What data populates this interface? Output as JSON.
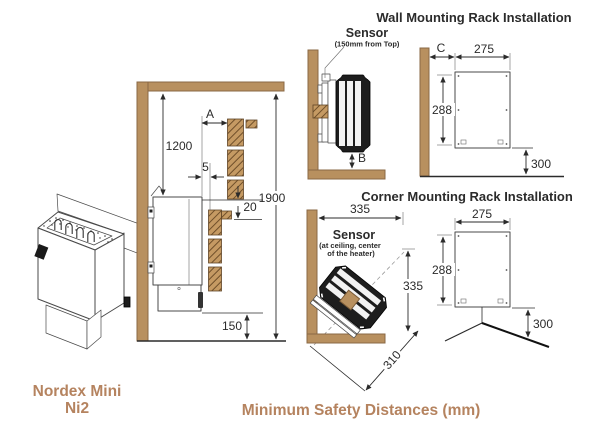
{
  "titles": {
    "wall": "Wall Mounting Rack Installation",
    "corner": "Corner Mounting Rack Installation",
    "safety": "Minimum Safety Distances (mm)"
  },
  "product": {
    "name_line1": "Nordex Mini",
    "name_line2": "Ni2"
  },
  "side_view": {
    "dim_ceiling": "1200",
    "dim_a": "A",
    "dim_side_gap": "5",
    "dim_total_height": "1900",
    "dim_above_gap": "20",
    "dim_floor": "150"
  },
  "wall_install": {
    "sensor": "Sensor",
    "sensor_note": "(150mm from Top)",
    "dim_b": "B",
    "dim_c": "C",
    "rack_width": "275",
    "rack_height": "288",
    "rack_floor": "300"
  },
  "corner_install": {
    "sensor": "Sensor",
    "sensor_note1": "(at ceiling, center",
    "sensor_note2": "of the heater)",
    "dim_wall_to_edge": "335",
    "dim_height": "335",
    "dim_diagonal": "310",
    "rack_width": "275",
    "rack_height": "288",
    "rack_floor": "300"
  },
  "colors": {
    "wood": "#b8905f",
    "wood_outline": "#8a6844",
    "hatch_line": "#6f4f2a",
    "accent_text": "#b5835f",
    "ink": "#2b2b2b"
  }
}
